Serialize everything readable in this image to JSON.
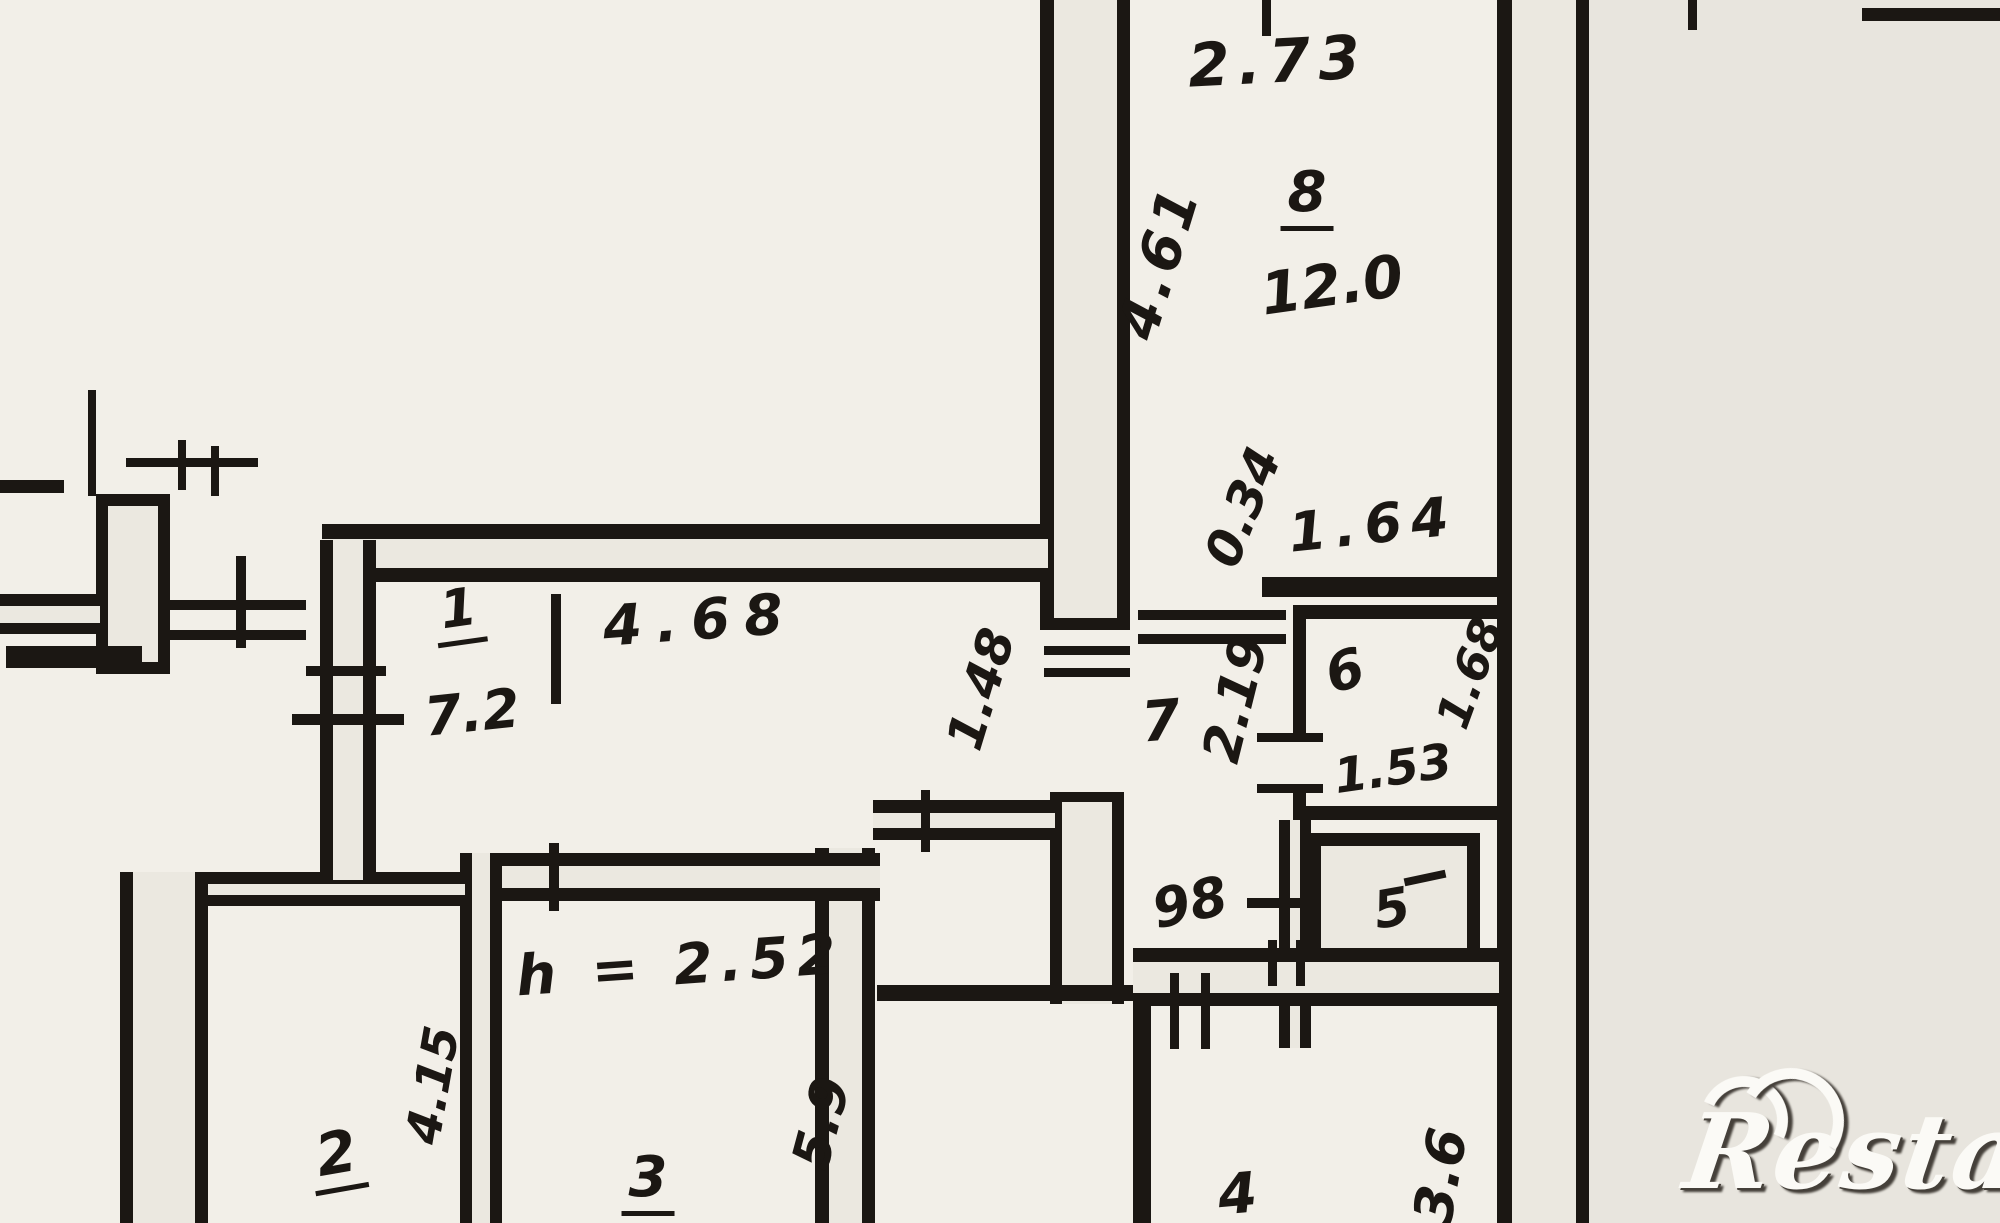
{
  "meta": {
    "type": "floor-plan",
    "ink_color": "#1b1713",
    "paper_color": "#f2efe8",
    "wall_fill_color": "#ebe8e0",
    "watermark_color": "#fbfaf6"
  },
  "watermark": {
    "brand": "Restate"
  },
  "plan": {
    "rooms": [
      {
        "id": "room-1",
        "number": "1",
        "area": "7.2"
      },
      {
        "id": "room-2",
        "number": "2"
      },
      {
        "id": "room-3",
        "number": "3",
        "note": "h = 2.52"
      },
      {
        "id": "room-4",
        "number": "4"
      },
      {
        "id": "room-5",
        "number": "5"
      },
      {
        "id": "room-6",
        "number": "6"
      },
      {
        "id": "room-7",
        "number": "7"
      },
      {
        "id": "room-8",
        "number": "8",
        "area": "12.0"
      }
    ],
    "dimensions": {
      "room8_width": "2.73",
      "room8_depth": "4.61",
      "opening_034": "0.34",
      "opening_164": "1.64",
      "room6_width": "1.53",
      "room6_depth": "1.68",
      "hall7_depth": "2.19",
      "hall7_door": "98",
      "hall1_width": "4.68",
      "hall1_depth": "1.48",
      "room2_depth": "4.15",
      "room3_depth": "5.9",
      "room4_depth": "3.6"
    }
  }
}
